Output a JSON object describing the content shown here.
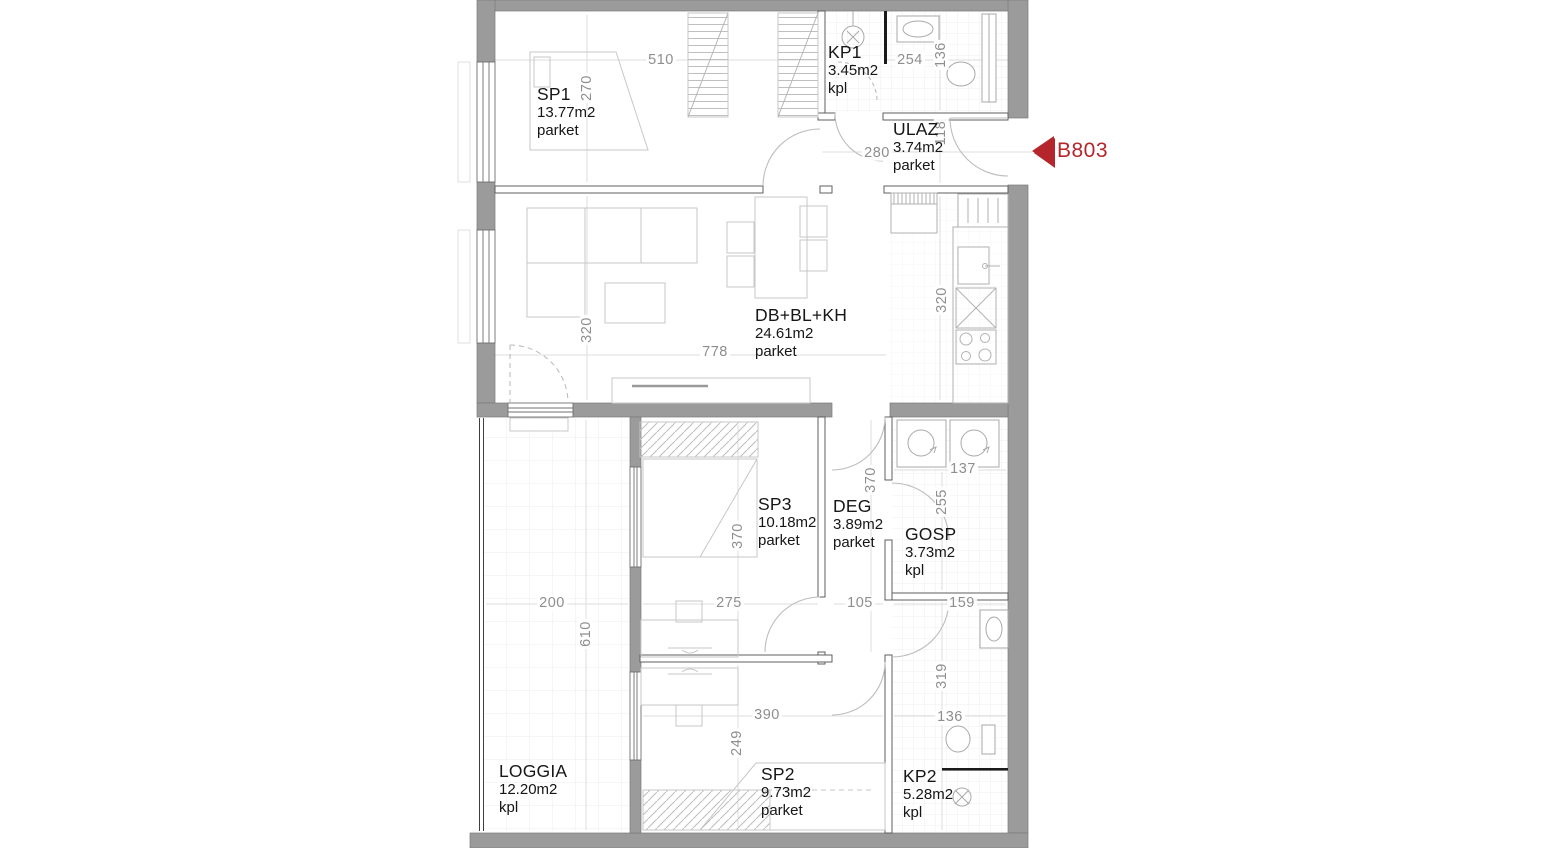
{
  "unit": {
    "label": "B803",
    "accent_color": "#b4262b"
  },
  "colors": {
    "wall": "#9b9b9b",
    "partition_stroke": "#5f5f5f",
    "furniture": "#c7c7c7",
    "fixture": "#a9a9a9",
    "dim_text": "#8e8e8e",
    "label_text": "#161616"
  },
  "rooms": {
    "sp1": {
      "name": "SP1",
      "area": "13.77m2",
      "floor": "parket"
    },
    "kp1": {
      "name": "KP1",
      "area": "3.45m2",
      "floor": "kpl"
    },
    "ulaz": {
      "name": "ULAZ",
      "area": "3.74m2",
      "floor": "parket"
    },
    "db": {
      "name": "DB+BL+KH",
      "area": "24.61m2",
      "floor": "parket"
    },
    "sp3": {
      "name": "SP3",
      "area": "10.18m2",
      "floor": "parket"
    },
    "deg": {
      "name": "DEG",
      "area": "3.89m2",
      "floor": "parket"
    },
    "gosp": {
      "name": "GOSP",
      "area": "3.73m2",
      "floor": "kpl"
    },
    "loggia": {
      "name": "LOGGIA",
      "area": "12.20m2",
      "floor": "kpl"
    },
    "sp2": {
      "name": "SP2",
      "area": "9.73m2",
      "floor": "parket"
    },
    "kp2": {
      "name": "KP2",
      "area": "5.28m2",
      "floor": "kpl"
    }
  },
  "dims": [
    {
      "t": "510"
    },
    {
      "t": "270"
    },
    {
      "t": "254"
    },
    {
      "t": "136"
    },
    {
      "t": "280"
    },
    {
      "t": "118"
    },
    {
      "t": "320"
    },
    {
      "t": "778"
    },
    {
      "t": "320"
    },
    {
      "t": "370"
    },
    {
      "t": "137"
    },
    {
      "t": "255"
    },
    {
      "t": "370"
    },
    {
      "t": "275"
    },
    {
      "t": "105"
    },
    {
      "t": "159"
    },
    {
      "t": "200"
    },
    {
      "t": "610"
    },
    {
      "t": "390"
    },
    {
      "t": "249"
    },
    {
      "t": "319"
    },
    {
      "t": "136"
    }
  ]
}
